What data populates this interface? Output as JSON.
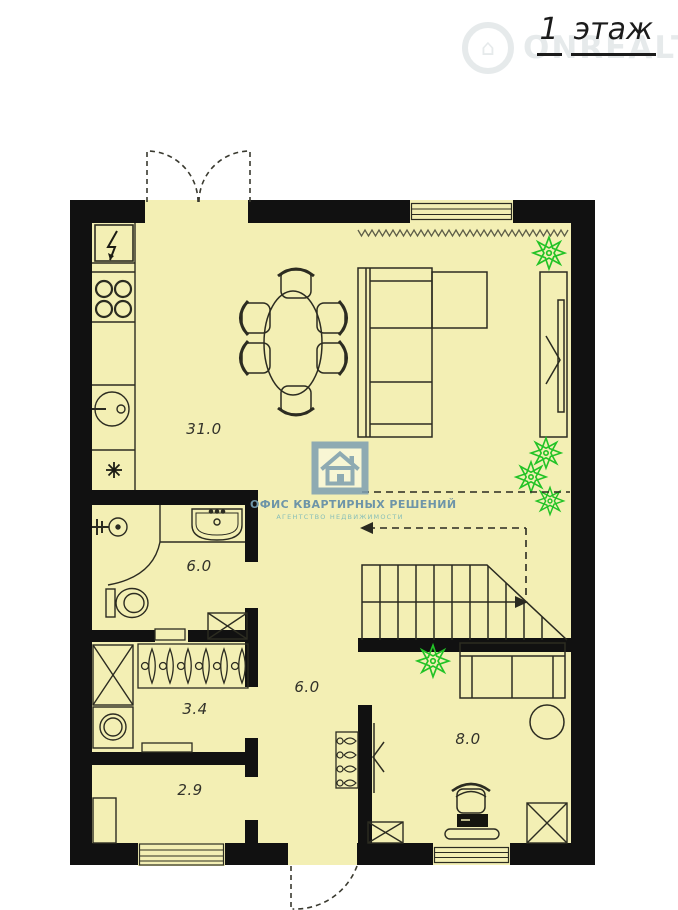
{
  "header": {
    "floor_number": "1",
    "floor_word": "этаж"
  },
  "watermark": {
    "site_text": "ONREALT",
    "house_glyph": "⌂"
  },
  "agency_logo": {
    "title": "ОФИС КВАРТИРНЫХ РЕШЕНИЙ",
    "subtitle": "АГЕНТСТВО НЕДВИЖИМОСТИ"
  },
  "rooms": [
    {
      "id": "kitchen-living-room",
      "area_label": "31.0"
    },
    {
      "id": "bathroom",
      "area_label": "6.0"
    },
    {
      "id": "dressing-room",
      "area_label": "3.4"
    },
    {
      "id": "hallway",
      "area_label": "6.0"
    },
    {
      "id": "entry",
      "area_label": "2.9"
    },
    {
      "id": "study",
      "area_label": "8.0"
    }
  ],
  "symbols": {
    "electrical_panel": "lightning-bolt",
    "kitchen_vent": "asterisk-star",
    "plants": "eight-point-star-flower",
    "stair_direction": "arrow-right",
    "upper_floor_opening": "dashed-outline-arrow-left",
    "doors": "dashed-swing-arcs"
  },
  "colors": {
    "background": "#ffffff",
    "plan_fill": "#f3efb4",
    "walls": "#111111",
    "furniture_lines": "#2c2c21",
    "plant_green": "#28c32b",
    "logo_blue": "#7d9fb2",
    "logo_text": "#6e95a8",
    "logo_subtitle_teal": "#85bdb8",
    "watermark_gray": "#6f8790"
  }
}
